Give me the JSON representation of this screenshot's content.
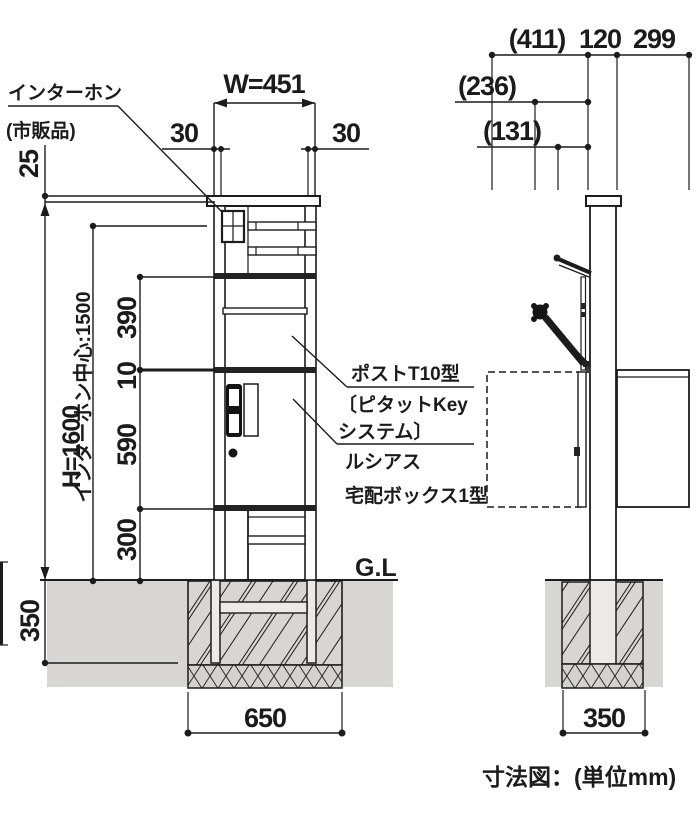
{
  "caption": "寸法図：(単位mm)",
  "front_view": {
    "intercom_label": "インターホン",
    "intercom_note": "(市販品)",
    "ground_label": "G.L",
    "dims": {
      "width": "W=451",
      "side_offset_left": "30",
      "side_offset_right": "30",
      "cap_height": "25",
      "total_height": "H=1600",
      "intercom_center": "インターホン中心:1500",
      "upper_section": "390",
      "gap": "10",
      "middle_section": "590",
      "lower_section": "300",
      "embed_depth": "350",
      "footing_width": "650"
    }
  },
  "side_view": {
    "dims": {
      "open_depth": "(411)",
      "post_depth": "120",
      "rear_depth": "299",
      "door_projection": "(236)",
      "lid_projection": "(131)",
      "footing_width": "350"
    }
  },
  "product_labels": {
    "post_model": "ポストT10型",
    "post_system_line1": "〔ピタットKey",
    "post_system_line2": "システム〕",
    "series": "ルシアス",
    "product": "宅配ボックス1型"
  }
}
